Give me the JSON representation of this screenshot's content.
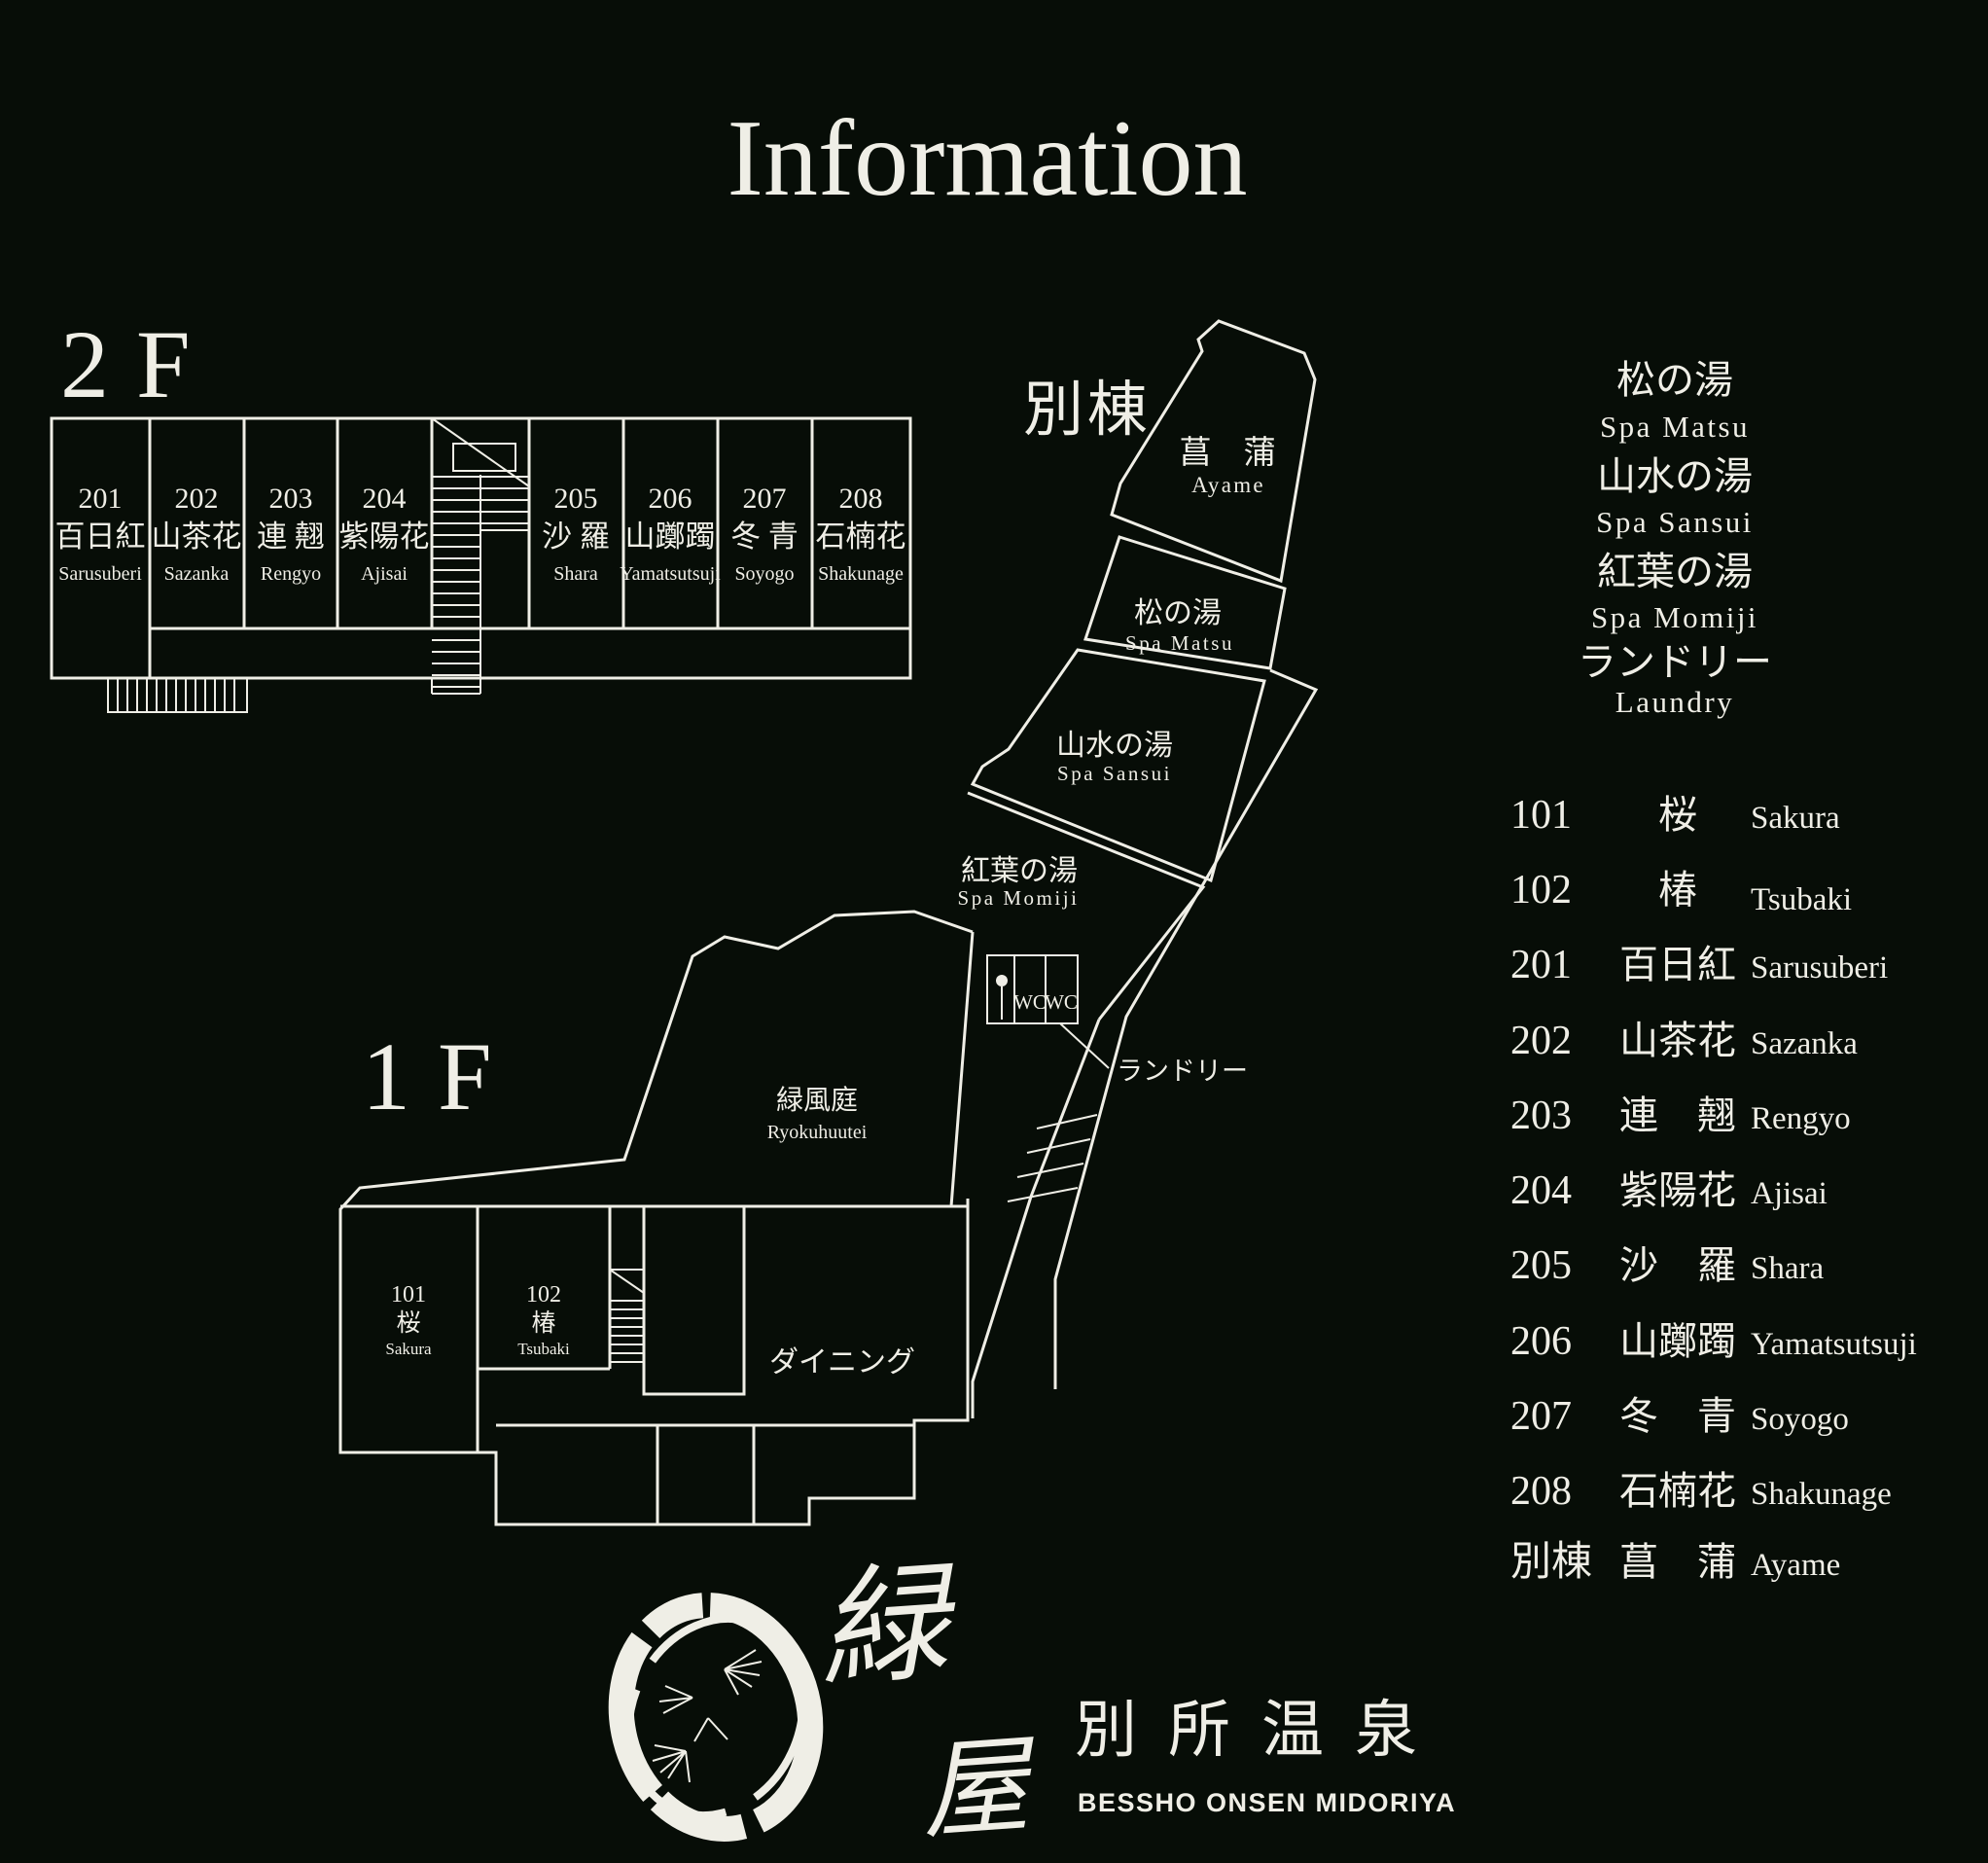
{
  "title": "Information",
  "colors": {
    "bg": "#070d07",
    "line": "#efeee6"
  },
  "floor2": {
    "label": "2F",
    "rooms": [
      {
        "no": "201",
        "kanji": "百日紅",
        "romaji": "Sarusuberi"
      },
      {
        "no": "202",
        "kanji": "山茶花",
        "romaji": "Sazanka"
      },
      {
        "no": "203",
        "kanji": "連 翹",
        "romaji": "Rengyo"
      },
      {
        "no": "204",
        "kanji": "紫陽花",
        "romaji": "Ajisai"
      },
      {
        "no": "205",
        "kanji": "沙 羅",
        "romaji": "Shara"
      },
      {
        "no": "206",
        "kanji": "山躑躅",
        "romaji": "Yamatsutsuji"
      },
      {
        "no": "207",
        "kanji": "冬 青",
        "romaji": "Soyogo"
      },
      {
        "no": "208",
        "kanji": "石楠花",
        "romaji": "Shakunage"
      }
    ]
  },
  "floor1": {
    "label": "1F",
    "garden": {
      "jp": "緑風庭",
      "en": "Ryokuhuutei"
    },
    "dining_label": "ダイニング",
    "laundry_label": "ランドリー",
    "wc": [
      "WC",
      "WC"
    ],
    "rooms": [
      {
        "no": "101",
        "kanji": "桜",
        "romaji": "Sakura"
      },
      {
        "no": "102",
        "kanji": "椿",
        "romaji": "Tsubaki"
      }
    ]
  },
  "annex": {
    "label": "別棟",
    "room": {
      "kanji": "菖　蒲",
      "romaji": "Ayame"
    }
  },
  "spas": {
    "matsu": {
      "jp": "松の湯",
      "en": "Spa  Matsu"
    },
    "sansui": {
      "jp": "山水の湯",
      "en": "Spa  Sansui"
    },
    "momiji": {
      "jp": "紅葉の湯",
      "en": "Spa  Momiji"
    }
  },
  "legend": {
    "items": [
      {
        "jp": "松の湯",
        "en": "Spa  Matsu"
      },
      {
        "jp": "山水の湯",
        "en": "Spa  Sansui"
      },
      {
        "jp": "紅葉の湯",
        "en": "Spa  Momiji"
      },
      {
        "jp": "ランドリー",
        "en": "Laundry"
      }
    ]
  },
  "room_list": [
    {
      "no": "101",
      "kanji": "桜",
      "romaji": "Sakura"
    },
    {
      "no": "102",
      "kanji": "椿",
      "romaji": "Tsubaki"
    },
    {
      "no": "201",
      "kanji": "百日紅",
      "romaji": "Sarusuberi"
    },
    {
      "no": "202",
      "kanji": "山茶花",
      "romaji": "Sazanka"
    },
    {
      "no": "203",
      "kanji": "連　翹",
      "romaji": "Rengyo"
    },
    {
      "no": "204",
      "kanji": "紫陽花",
      "romaji": "Ajisai"
    },
    {
      "no": "205",
      "kanji": "沙　羅",
      "romaji": "Shara"
    },
    {
      "no": "206",
      "kanji": "山躑躅",
      "romaji": "Yamatsutsuji"
    },
    {
      "no": "207",
      "kanji": "冬　青",
      "romaji": "Soyogo"
    },
    {
      "no": "208",
      "kanji": "石楠花",
      "romaji": "Shakunage"
    },
    {
      "no": "別棟",
      "kanji": "菖　蒲",
      "romaji": "Ayame"
    }
  ],
  "logo": {
    "mark_char_1": "緑",
    "mark_char_2": "屋",
    "name_jp": "別所温泉",
    "name_en": "BESSHO ONSEN MIDORIYA"
  }
}
